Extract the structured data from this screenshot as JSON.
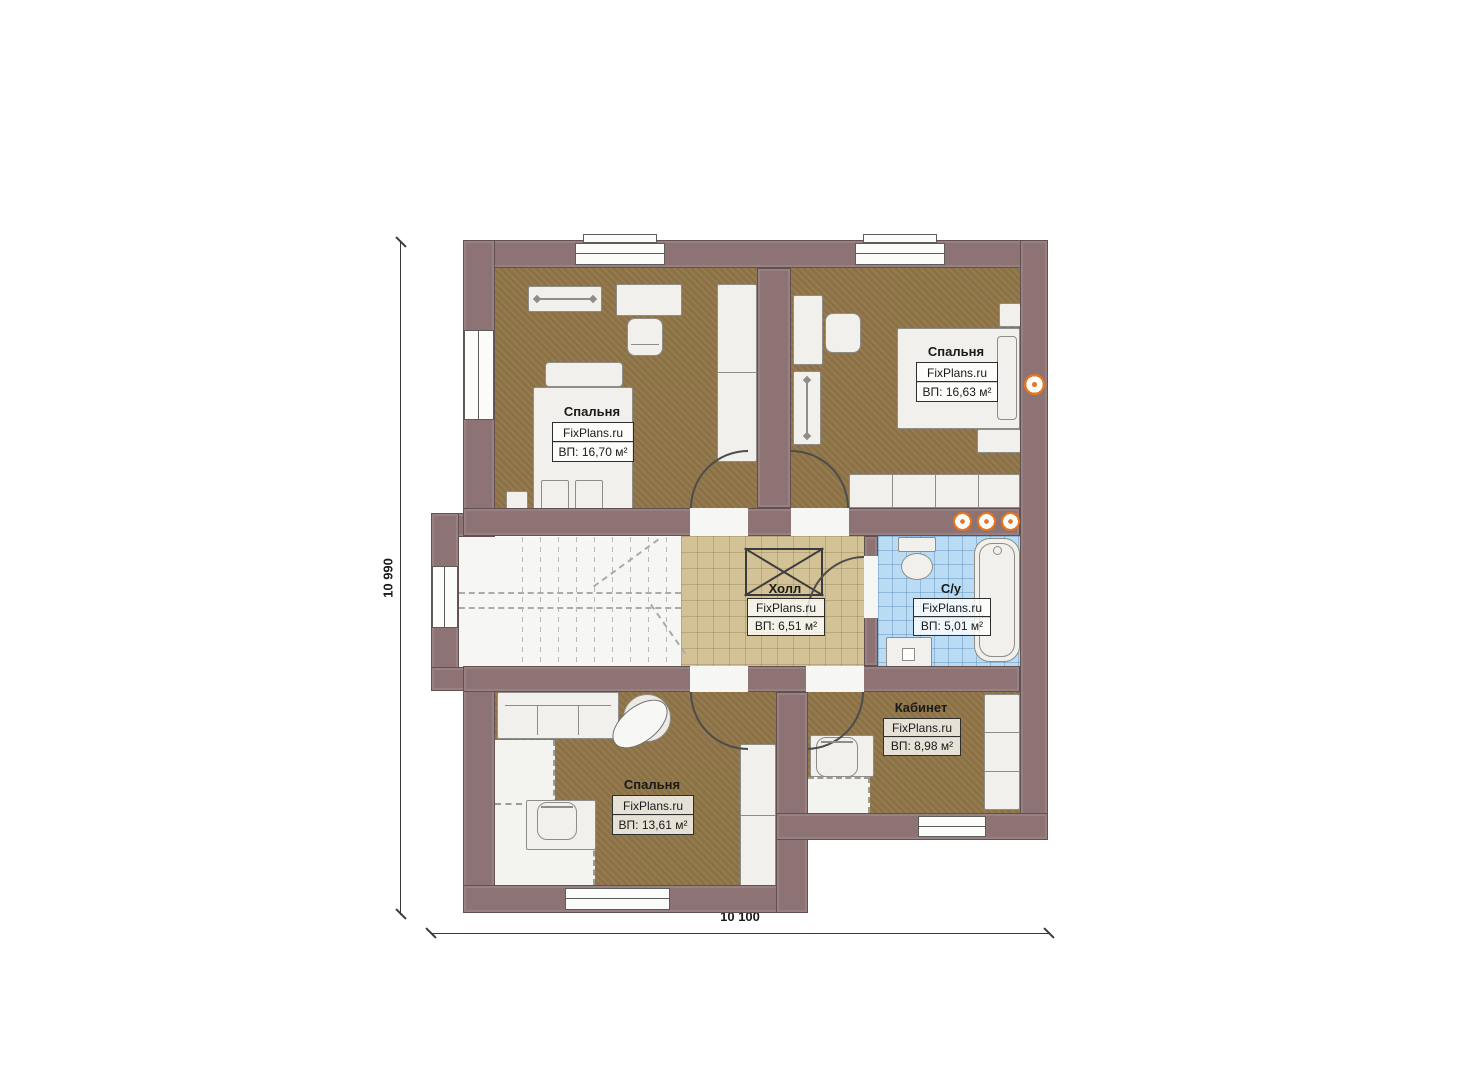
{
  "plan": {
    "dimensions": {
      "vertical": "10 990",
      "horizontal": "10 100"
    },
    "colors": {
      "wall": "#8d7374",
      "floor_wood": "#8f7547",
      "floor_tile_hall": "#d3c295",
      "floor_tile_bath": "#b9dcf4",
      "accent_orange": "#e8761e"
    },
    "rooms": {
      "bedroom_tl": {
        "name": "Спальня",
        "brand": "FixPlans.ru",
        "area": "ВП: 16,70 м²"
      },
      "bedroom_tr": {
        "name": "Спальня",
        "brand": "FixPlans.ru",
        "area": "ВП: 16,63 м²"
      },
      "hall": {
        "name": "Холл",
        "brand": "FixPlans.ru",
        "area": "ВП: 6,51 м²"
      },
      "bathroom": {
        "name": "С/у",
        "brand": "FixPlans.ru",
        "area": "ВП: 5,01 м²"
      },
      "bedroom_bl": {
        "name": "Спальня",
        "brand": "FixPlans.ru",
        "area": "ВП: 13,61 м²"
      },
      "study": {
        "name": "Кабинет",
        "brand": "FixPlans.ru",
        "area": "ВП: 8,98 м²"
      }
    }
  }
}
